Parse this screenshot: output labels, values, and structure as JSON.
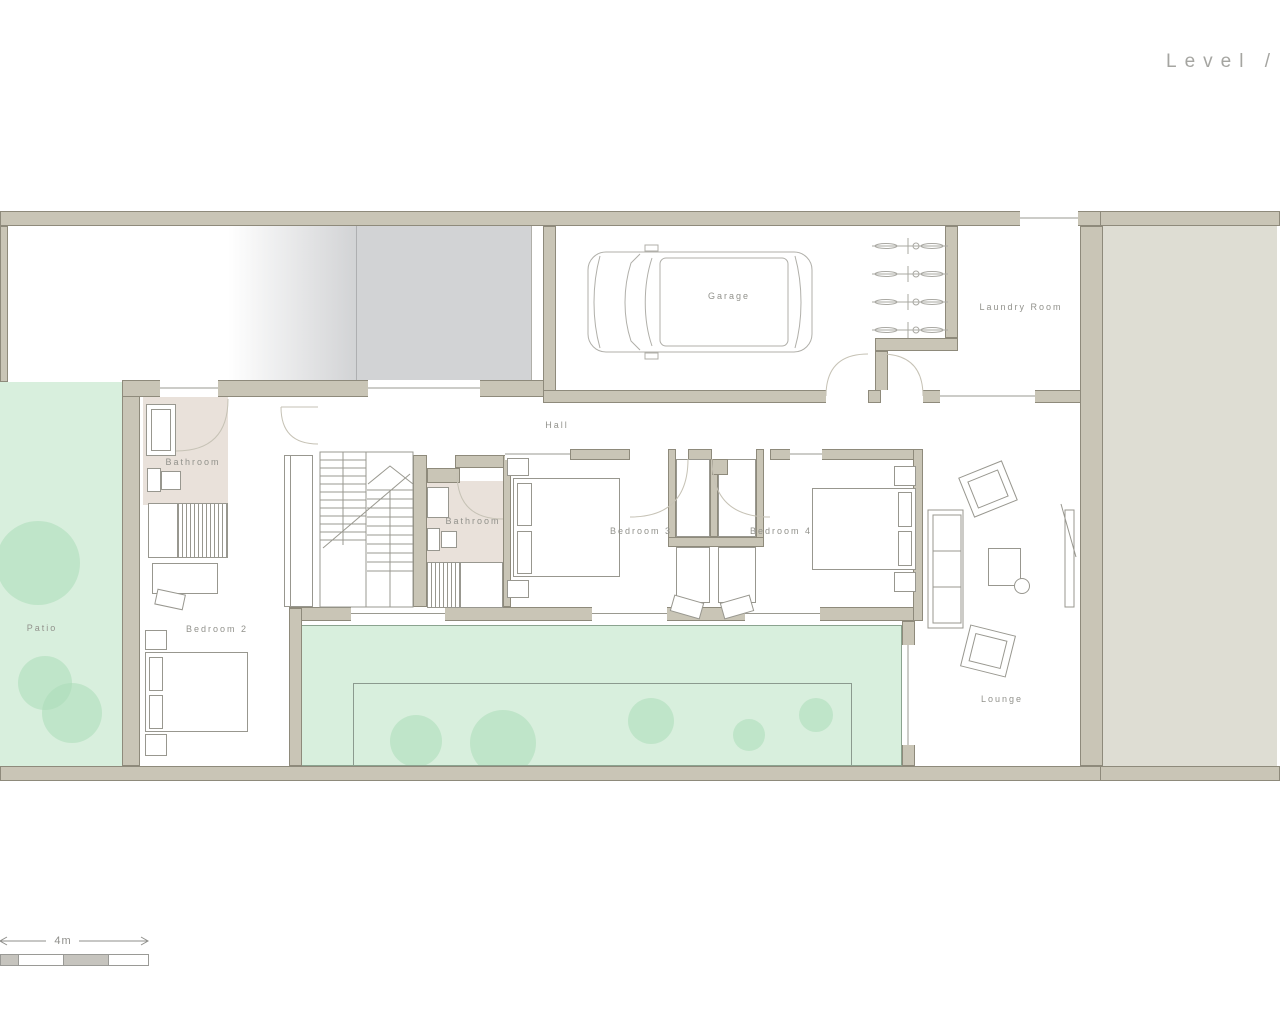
{
  "title": {
    "label": "Level /"
  },
  "rooms": [
    {
      "id": "garage",
      "label": "Garage"
    },
    {
      "id": "laundry-room",
      "label": "Laundry Room"
    },
    {
      "id": "hall",
      "label": "Hall"
    },
    {
      "id": "bathroom-1",
      "label": "Bathroom"
    },
    {
      "id": "bathroom-2",
      "label": "Bathroom"
    },
    {
      "id": "bedroom-2",
      "label": "Bedroom 2"
    },
    {
      "id": "bedroom-3",
      "label": "Bedroom 3"
    },
    {
      "id": "bedroom-4",
      "label": "Bedroom 4"
    },
    {
      "id": "patio",
      "label": "Patio"
    },
    {
      "id": "lounge",
      "label": "Lounge"
    }
  ],
  "scale_bar": {
    "label": "4m"
  },
  "colors": {
    "wall_fill": "#c9c5b6",
    "wall_outline": "#8e8a7b",
    "green_area": "#d8efdd",
    "green_accent": "#abdcb8",
    "bathroom_floor": "#e9e1da",
    "side_area": "#deddd3",
    "ramp_gray": "#d2d3d5",
    "label_text": "#92928c"
  }
}
